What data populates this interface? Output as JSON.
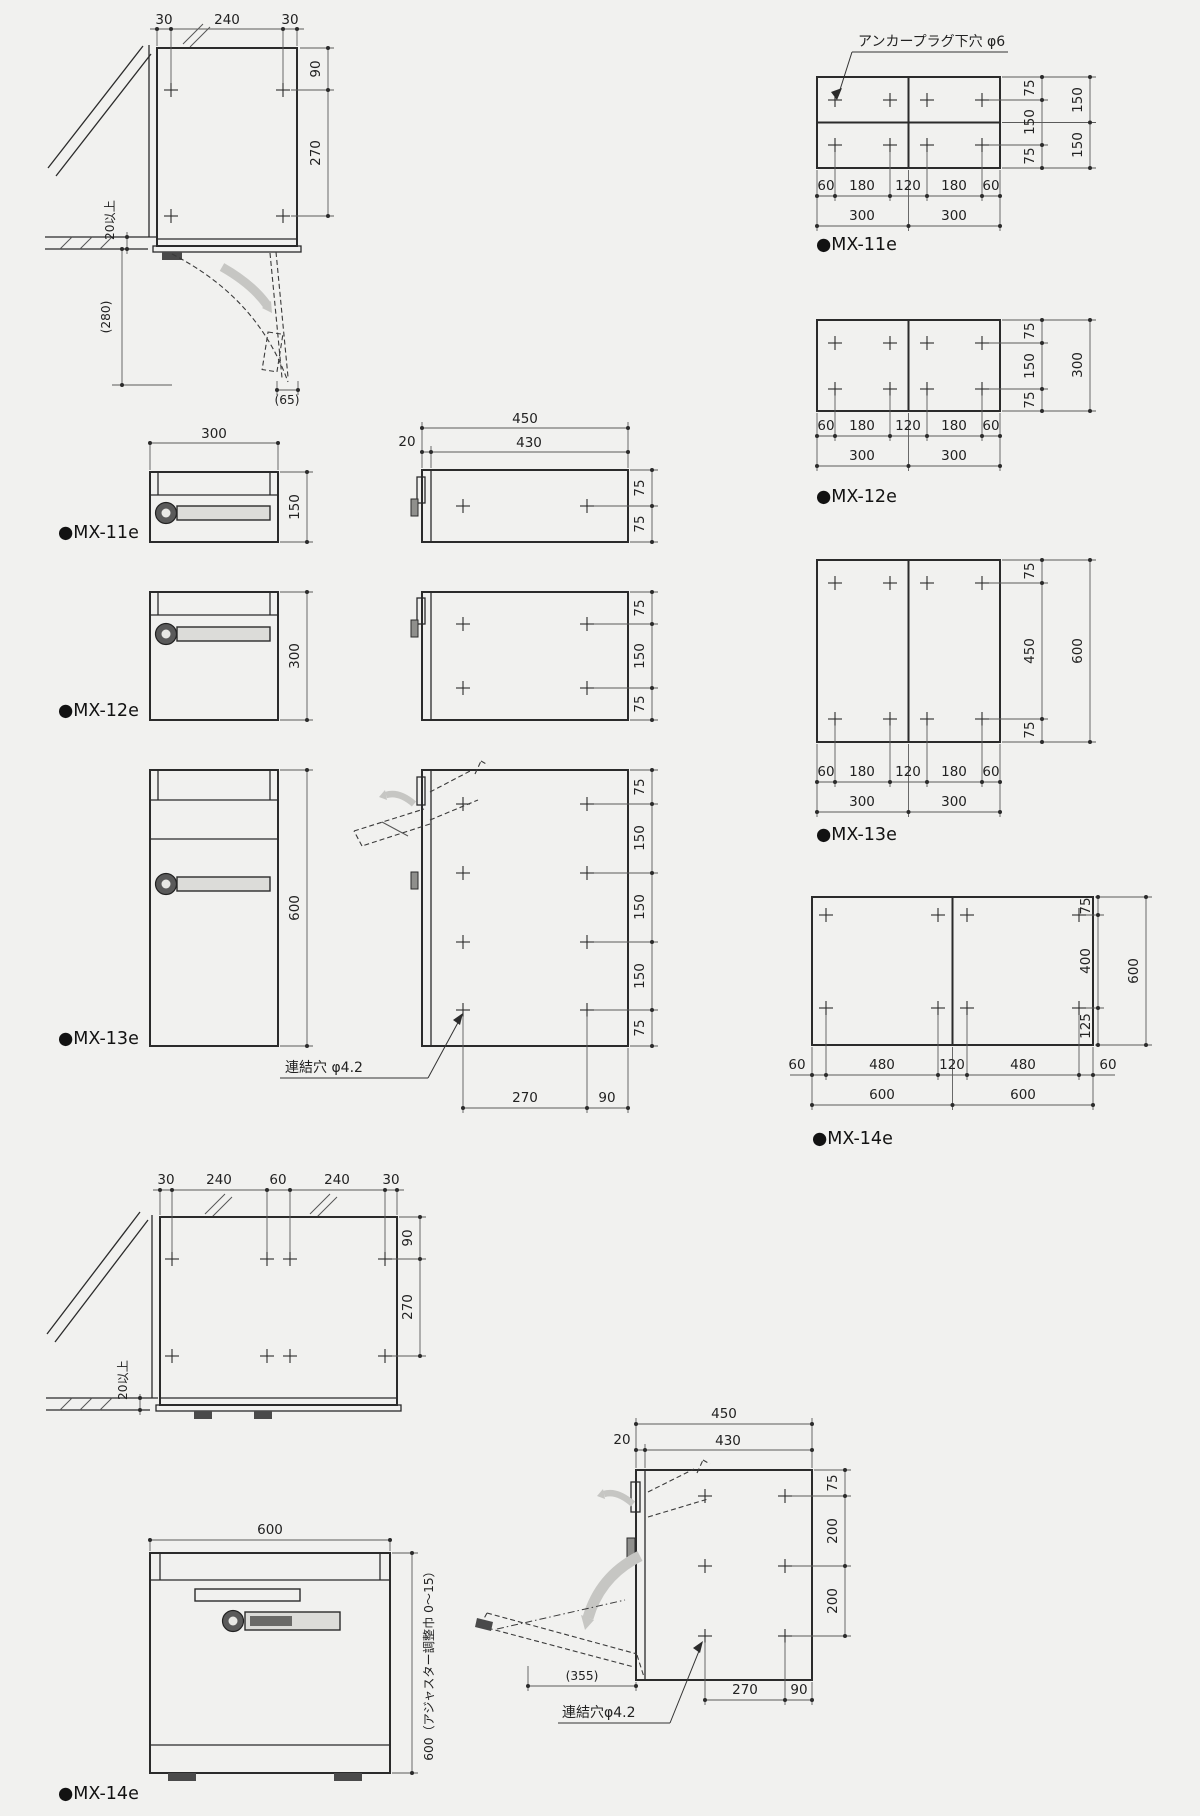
{
  "colors": {
    "background": "#f1f1ef",
    "line": "#2b2b2b",
    "dim": "#5a5a5a",
    "arrow": "#c6c6c3",
    "handle": "#dcdcd9"
  },
  "installTop": {
    "top": [
      "30",
      "240",
      "30"
    ],
    "right": [
      "90",
      "270"
    ],
    "clearance": "20以上",
    "swing": "(280)",
    "door": "(65)"
  },
  "anchorNote": "アンカープラグ下穴 φ6",
  "patterns": {
    "mx11e": {
      "label": "●MX-11e",
      "inner": [
        "75",
        "150",
        "75"
      ],
      "outer": [
        "150",
        "150"
      ],
      "holes": [
        "60",
        "180",
        "120",
        "180",
        "60"
      ],
      "totals": [
        "300",
        "300"
      ]
    },
    "mx12e": {
      "label": "●MX-12e",
      "inner": [
        "75",
        "150",
        "75"
      ],
      "outer": [
        "300"
      ],
      "holes": [
        "60",
        "180",
        "120",
        "180",
        "60"
      ],
      "totals": [
        "300",
        "300"
      ]
    },
    "mx13e": {
      "label": "●MX-13e",
      "inner": [
        "75",
        "450",
        "75"
      ],
      "outer": [
        "600"
      ],
      "holes": [
        "60",
        "180",
        "120",
        "180",
        "60"
      ],
      "totals": [
        "300",
        "300"
      ]
    },
    "mx14e": {
      "label": "●MX-14e",
      "inner": [
        "75",
        "400",
        "125"
      ],
      "outer": [
        "600"
      ],
      "holes": [
        "60",
        "480",
        "120",
        "480",
        "60"
      ],
      "totals": [
        "600",
        "600"
      ]
    }
  },
  "views": {
    "mx11e": {
      "label": "●MX-11e",
      "width": "300",
      "height": "150",
      "depth": [
        "450",
        "20",
        "430"
      ],
      "side": [
        "75",
        "75"
      ]
    },
    "mx12e": {
      "label": "●MX-12e",
      "height": "300",
      "side": [
        "75",
        "150",
        "75"
      ]
    },
    "mx13e": {
      "label": "●MX-13e",
      "height": "600",
      "side": [
        "75",
        "150",
        "150",
        "150",
        "75"
      ],
      "linkHole": "連結穴 φ4.2",
      "bottom": [
        "270",
        "90"
      ]
    }
  },
  "installBottom": {
    "top": [
      "30",
      "240",
      "60",
      "240",
      "30"
    ],
    "right": [
      "90",
      "270"
    ],
    "clearance": "20以上"
  },
  "mx14front": {
    "width": "600",
    "adjuster": "600（アジャスター調整巾 0〜15）",
    "label": "●MX-14e"
  },
  "mx14side": {
    "depth": [
      "450",
      "20",
      "430"
    ],
    "side": [
      "75",
      "200",
      "200"
    ],
    "swing": "(355)",
    "linkHole": "連結穴φ4.2",
    "bottom": [
      "270",
      "90"
    ]
  }
}
